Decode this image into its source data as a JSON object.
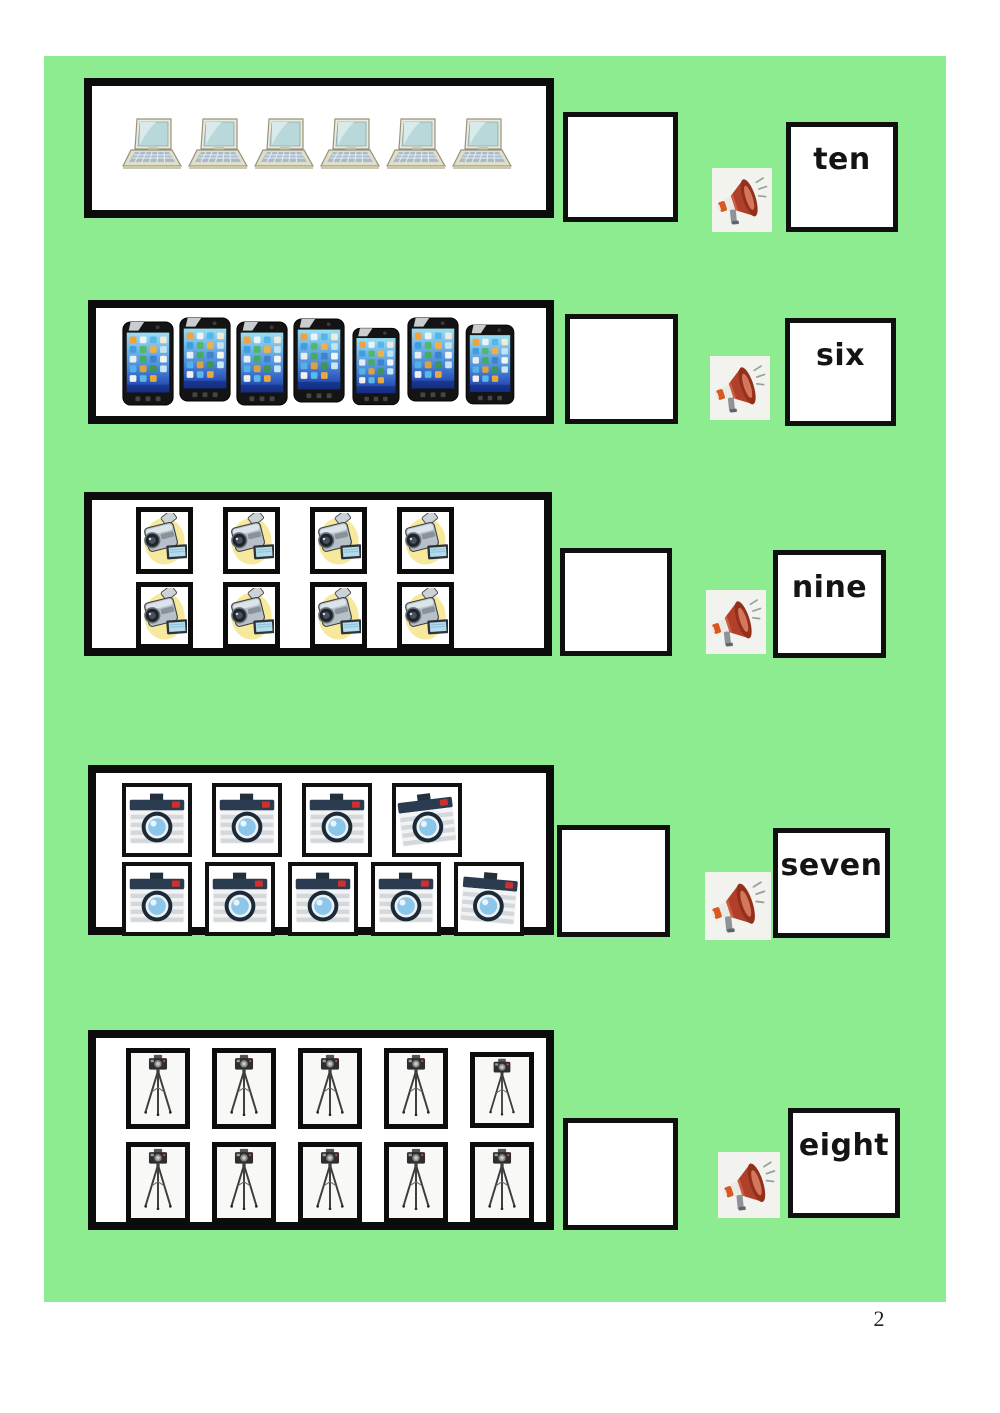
{
  "page": {
    "number": "2"
  },
  "colors": {
    "panel_green": "#8deb90",
    "box_border": "#0c0c0c",
    "megaphone_red": "#b0402a"
  },
  "icons": {
    "audio": "megaphone-icon"
  },
  "rows": [
    {
      "object": "laptop",
      "object_label": "laptop",
      "count": 6,
      "layout": [
        6
      ],
      "framed": false,
      "word": "ten",
      "answer": ""
    },
    {
      "object": "smartphone",
      "object_label": "smartphone",
      "count": 7,
      "layout": [
        7
      ],
      "framed": false,
      "word": "six",
      "answer": ""
    },
    {
      "object": "camcorder",
      "object_label": "video camera",
      "count": 8,
      "layout": [
        4,
        4
      ],
      "framed": true,
      "word": "nine",
      "answer": ""
    },
    {
      "object": "camera",
      "object_label": "photo camera",
      "count": 9,
      "layout": [
        4,
        5
      ],
      "framed": true,
      "word": "seven",
      "answer": ""
    },
    {
      "object": "tripod-camera",
      "object_label": "camera on tripod",
      "count": 10,
      "layout": [
        5,
        5
      ],
      "framed": true,
      "word": "eight",
      "answer": ""
    }
  ]
}
